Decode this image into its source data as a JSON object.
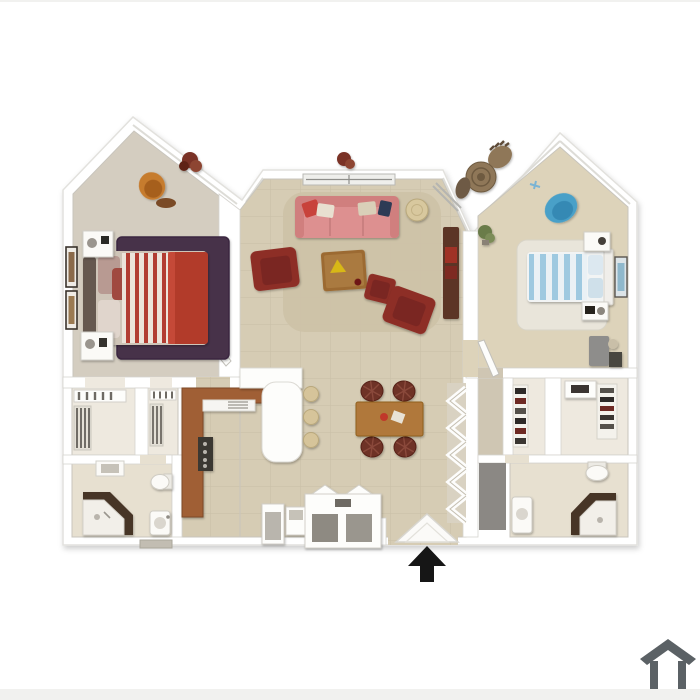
{
  "image": {
    "kind": "3d-apartment-floor-plan",
    "description": "Top-down 3D rendering of a two-bedroom, two-bathroom apartment floor plan with gabled bedroom walls, on a plain white background",
    "entry_marker_icon": "up-arrow-icon",
    "watermark_icon": "house-outline-icon"
  },
  "rooms": [
    {
      "name": "bedroom-left",
      "items": [
        "red and white striped bed",
        "solid red blanket",
        "plum area rug",
        "two white nightstands with lamps",
        "orange desk chair",
        "two framed wall pictures",
        "dark red wall plant"
      ]
    },
    {
      "name": "living-room",
      "items": [
        "pink sofa with throw pillows",
        "dark red armchair",
        "two dark red accent chairs",
        "square wood coffee table",
        "round side table",
        "tan shag rug",
        "dark wood console",
        "window wall",
        "wall plant"
      ]
    },
    {
      "name": "kitchen",
      "items": [
        "L-shaped wood counter",
        "range with burners",
        "sink",
        "white breakfast bar",
        "three round barstools"
      ]
    },
    {
      "name": "dining-area",
      "items": [
        "rectangular wood table",
        "four round-back wicker chairs",
        "centerpiece"
      ]
    },
    {
      "name": "bedroom-right",
      "items": [
        "blue and white striped bed",
        "white shag rug",
        "blue armchair",
        "two nightstands",
        "gray dresser with lamp and photo",
        "framed wall art",
        "green floor plant"
      ]
    },
    {
      "name": "patio-nook",
      "items": [
        "round wicker bistro table",
        "two wicker chairs"
      ]
    },
    {
      "name": "closets-left",
      "items": [
        "two reach-in closets with shelves and hanging clothes"
      ]
    },
    {
      "name": "bathroom-left",
      "items": [
        "corner shower with dark walls",
        "toilet",
        "pedestal sink",
        "wall cabinet"
      ]
    },
    {
      "name": "closets-right",
      "items": [
        "walk-in closet with shoe shelves",
        "white cabinet",
        "shoe rack"
      ]
    },
    {
      "name": "bathroom-right",
      "items": [
        "corner shower with dark walls",
        "toilet",
        "vanity",
        "gray door slab"
      ]
    },
    {
      "name": "entry",
      "items": [
        "angled entry portico",
        "built-in cabinets",
        "black entry direction arrow"
      ]
    }
  ],
  "colors": {
    "background": "#ffffff",
    "edge_strip": "#f1f1ef",
    "wall_line": "#cfccc6",
    "floor_tile": "#d6ccb4",
    "floor_carpet_left": "#d4cdc0",
    "floor_carpet_right": "#ddd3ba",
    "floor_closet": "#eee9df",
    "floor_bath": "#e7e0d0",
    "hall_floor": "#cfc6b3",
    "bed1_stripe_red": "#b23c30",
    "bed1_stripe_cream": "#ece4da",
    "bed1_blanket": "#b23a2a",
    "bed1_headboard": "#65594f",
    "bed1_mattress": "#cfc5b8",
    "rug1": "#46304a",
    "sofa": "#dd9090",
    "sofa_dark": "#d07f7e",
    "armchair": "#8d2f28",
    "coffee_table": "#9c6b33",
    "living_rug": "#cdc2a8",
    "console": "#5c3526",
    "console_accent": "#a03028",
    "side_table": "#d8c89e",
    "dining_table": "#b0783a",
    "dining_chair": "#6e3028",
    "kitchen_counter": "#a05f35",
    "stove": "#3b3733",
    "stool": "#d6c49a",
    "bed2_stripe_blue": "#9ec9e0",
    "bed2_stripe_white": "#eaf1f5",
    "rug2": "#e9e5da",
    "armchair2": "#4aa0c8",
    "dresser2": "#8e8d8b",
    "bistro_wicker": "#8f7758",
    "shower_wall": "#473526",
    "shower_glass": "#f2efe9",
    "orange_chair": "#c67b2f",
    "plant_red": "#7a3226",
    "plant_green": "#6b7c4a",
    "fixture_white": "#fbfaf7",
    "gray_door": "#8b8884",
    "arrow": "#161616",
    "logo": "#5b6165"
  }
}
